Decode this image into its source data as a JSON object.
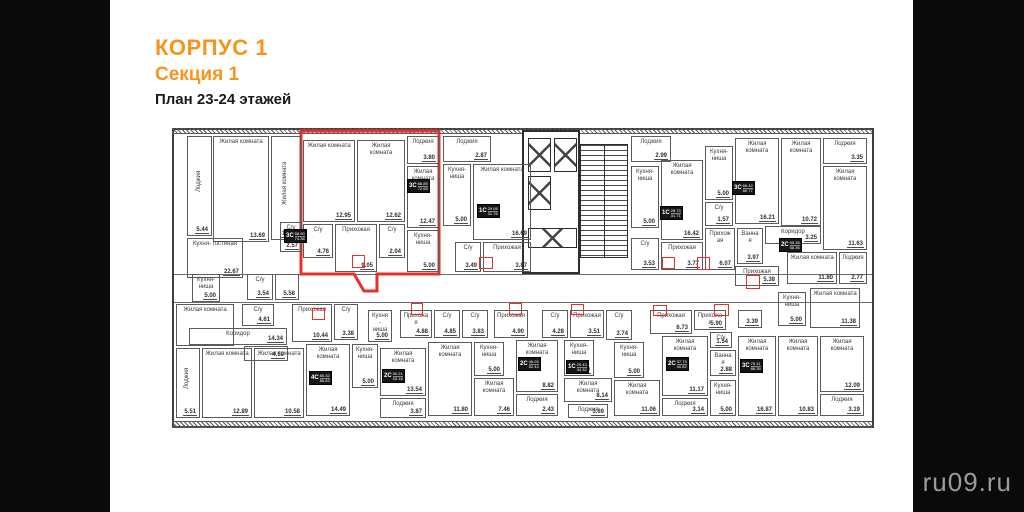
{
  "page": {
    "title1": "КОРПУС 1",
    "title2": "Секция 1",
    "title3": "План 23-24 этажей",
    "watermark": "ru09.ru",
    "accent_color": "#f7941d",
    "highlight_color": "#e5312b"
  },
  "plan": {
    "rooms": [
      {
        "label": "Лоджия",
        "area": "5.44",
        "x": 13,
        "y": 6,
        "w": 25,
        "h": 100,
        "vert": true
      },
      {
        "label": "Жилая комната",
        "area": "13.69",
        "x": 39,
        "y": 6,
        "w": 56,
        "h": 106
      },
      {
        "label": "Жилая комната",
        "area": "15.87",
        "x": 97,
        "y": 6,
        "w": 30,
        "h": 104,
        "vert": true
      },
      {
        "label": "Жилая комната",
        "area": "12.95",
        "x": 129,
        "y": 10,
        "w": 52,
        "h": 82
      },
      {
        "label": "Жилая комната",
        "area": "12.62",
        "x": 183,
        "y": 10,
        "w": 48,
        "h": 82
      },
      {
        "label": "Лоджия",
        "area": "3.80",
        "x": 233,
        "y": 6,
        "w": 32,
        "h": 28
      },
      {
        "label": "Жилая комната",
        "area": "12.47",
        "x": 233,
        "y": 36,
        "w": 32,
        "h": 62
      },
      {
        "label": "Кухня- ниша",
        "area": "5.00",
        "x": 233,
        "y": 100,
        "w": 32,
        "h": 42
      },
      {
        "label": "С/у",
        "area": "4.76",
        "x": 129,
        "y": 94,
        "w": 30,
        "h": 34
      },
      {
        "label": "Прихожая",
        "area": "9.05",
        "x": 161,
        "y": 94,
        "w": 42,
        "h": 48
      },
      {
        "label": "С/у",
        "area": "2.04",
        "x": 205,
        "y": 94,
        "w": 26,
        "h": 34
      },
      {
        "label": "С/у",
        "area": "2.57",
        "x": 106,
        "y": 92,
        "w": 22,
        "h": 30
      },
      {
        "label": "Кухня- гостиная",
        "area": "22.67",
        "x": 13,
        "y": 108,
        "w": 56,
        "h": 40
      },
      {
        "label": "Лоджия",
        "area": "2.87",
        "x": 269,
        "y": 6,
        "w": 48,
        "h": 26
      },
      {
        "label": "Кухня- ниша",
        "area": "5.00",
        "x": 269,
        "y": 34,
        "w": 28,
        "h": 62
      },
      {
        "label": "Жилая комната",
        "area": "16.69",
        "x": 299,
        "y": 34,
        "w": 58,
        "h": 76
      },
      {
        "label": "С/у",
        "area": "3.49",
        "x": 281,
        "y": 112,
        "w": 26,
        "h": 30
      },
      {
        "label": "Прихожая",
        "area": "3.87",
        "x": 309,
        "y": 112,
        "w": 48,
        "h": 30
      },
      {
        "label": "Лоджия",
        "area": "2.99",
        "x": 457,
        "y": 6,
        "w": 40,
        "h": 26
      },
      {
        "label": "Кухня- ниша",
        "area": "5.00",
        "x": 457,
        "y": 36,
        "w": 28,
        "h": 62
      },
      {
        "label": "С/у",
        "area": "3.53",
        "x": 457,
        "y": 108,
        "w": 28,
        "h": 32
      },
      {
        "label": "Жилая комната",
        "area": "16.42",
        "x": 487,
        "y": 30,
        "w": 42,
        "h": 80
      },
      {
        "label": "Прихожая",
        "area": "3.77",
        "x": 487,
        "y": 112,
        "w": 42,
        "h": 28
      },
      {
        "label": "Кухня- ниша",
        "area": "5.00",
        "x": 531,
        "y": 16,
        "w": 28,
        "h": 54
      },
      {
        "label": "С/у",
        "area": "1.57",
        "x": 531,
        "y": 72,
        "w": 28,
        "h": 24
      },
      {
        "label": "Прихожая",
        "area": "6.07",
        "x": 531,
        "y": 98,
        "w": 30,
        "h": 42
      },
      {
        "label": "Ванная",
        "area": "3.97",
        "x": 563,
        "y": 98,
        "w": 26,
        "h": 36
      },
      {
        "label": "Жилая комната",
        "area": "16.21",
        "x": 561,
        "y": 8,
        "w": 44,
        "h": 86
      },
      {
        "label": "Жилая комната",
        "area": "10.72",
        "x": 607,
        "y": 8,
        "w": 40,
        "h": 88
      },
      {
        "label": "Лоджия",
        "area": "3.35",
        "x": 649,
        "y": 8,
        "w": 44,
        "h": 26
      },
      {
        "label": "Жилая комната",
        "area": "11.63",
        "x": 649,
        "y": 36,
        "w": 44,
        "h": 84
      },
      {
        "label": "Коридор",
        "area": "3.25",
        "x": 591,
        "y": 96,
        "w": 56,
        "h": 18
      },
      {
        "label": "Жилая комната",
        "area": "11.80",
        "x": 613,
        "y": 122,
        "w": 50,
        "h": 32
      },
      {
        "label": "Лоджия",
        "area": "2.77",
        "x": 665,
        "y": 122,
        "w": 28,
        "h": 32
      },
      {
        "label": "Прихожая",
        "area": "5.38",
        "x": 561,
        "y": 136,
        "w": 44,
        "h": 20
      },
      {
        "label": "Кухня- ниша",
        "area": "5.00",
        "x": 18,
        "y": 144,
        "w": 28,
        "h": 28
      },
      {
        "label": "С/у",
        "area": "3.54",
        "x": 73,
        "y": 144,
        "w": 26,
        "h": 26
      },
      {
        "label": "",
        "area": "5.58",
        "x": 101,
        "y": 144,
        "w": 24,
        "h": 26
      },
      {
        "label": "Жилая комната",
        "area": "",
        "x": 2,
        "y": 174,
        "w": 58,
        "h": 42
      },
      {
        "label": "С/у",
        "area": "4.61",
        "x": 68,
        "y": 174,
        "w": 32,
        "h": 22
      },
      {
        "label": "Коридор",
        "area": "14.34",
        "x": 15,
        "y": 198,
        "w": 98,
        "h": 17
      },
      {
        "label": "",
        "area": "4.59",
        "x": 70,
        "y": 216,
        "w": 44,
        "h": 15
      },
      {
        "label": "Лоджия",
        "area": "5.51",
        "x": 2,
        "y": 218,
        "w": 24,
        "h": 70,
        "vert": true
      },
      {
        "label": "Жилая комната",
        "area": "12.89",
        "x": 28,
        "y": 218,
        "w": 50,
        "h": 70
      },
      {
        "label": "Жилая комната",
        "area": "10.58",
        "x": 80,
        "y": 218,
        "w": 50,
        "h": 70
      },
      {
        "label": "Прихожая",
        "area": "10.44",
        "x": 118,
        "y": 174,
        "w": 40,
        "h": 38
      },
      {
        "label": "С/у",
        "area": "3.38",
        "x": 160,
        "y": 174,
        "w": 24,
        "h": 36
      },
      {
        "label": "Жилая комната",
        "area": "14.49",
        "x": 132,
        "y": 214,
        "w": 44,
        "h": 72
      },
      {
        "label": "Кухня- ниша",
        "area": "5.00",
        "x": 178,
        "y": 214,
        "w": 26,
        "h": 44
      },
      {
        "label": "Кухня- ниша",
        "area": "5.00",
        "x": 194,
        "y": 180,
        "w": 24,
        "h": 32
      },
      {
        "label": "Жилая комната",
        "area": "13.54",
        "x": 206,
        "y": 218,
        "w": 46,
        "h": 48
      },
      {
        "label": "Лоджия",
        "area": "3.87",
        "x": 206,
        "y": 268,
        "w": 46,
        "h": 20
      },
      {
        "label": "Прихожая",
        "area": "4.88",
        "x": 226,
        "y": 180,
        "w": 32,
        "h": 28
      },
      {
        "label": "С/у",
        "area": "4.85",
        "x": 260,
        "y": 180,
        "w": 26,
        "h": 28
      },
      {
        "label": "Жилая комната",
        "area": "11.80",
        "x": 254,
        "y": 212,
        "w": 44,
        "h": 74
      },
      {
        "label": "С/у",
        "area": "3.83",
        "x": 288,
        "y": 180,
        "w": 26,
        "h": 28
      },
      {
        "label": "Кухня- ниша",
        "area": "5.00",
        "x": 300,
        "y": 212,
        "w": 30,
        "h": 34
      },
      {
        "label": "Жилая комната",
        "area": "7.46",
        "x": 300,
        "y": 248,
        "w": 40,
        "h": 38
      },
      {
        "label": "Прихожая",
        "area": "4.90",
        "x": 320,
        "y": 180,
        "w": 34,
        "h": 28
      },
      {
        "label": "Жилая комната",
        "area": "8.82",
        "x": 342,
        "y": 210,
        "w": 42,
        "h": 52
      },
      {
        "label": "Лоджия",
        "area": "2.43",
        "x": 342,
        "y": 264,
        "w": 42,
        "h": 22
      },
      {
        "label": "С/у",
        "area": "4.28",
        "x": 368,
        "y": 180,
        "w": 26,
        "h": 28
      },
      {
        "label": "Прихожая",
        "area": "3.51",
        "x": 396,
        "y": 180,
        "w": 34,
        "h": 28
      },
      {
        "label": "Кухня- ниша",
        "area": "5.00",
        "x": 390,
        "y": 210,
        "w": 30,
        "h": 36
      },
      {
        "label": "Жилая комната",
        "area": "8.14",
        "x": 390,
        "y": 248,
        "w": 48,
        "h": 24
      },
      {
        "label": "Лоджия",
        "area": "3.69",
        "x": 394,
        "y": 274,
        "w": 40,
        "h": 14
      },
      {
        "label": "С/у",
        "area": "3.74",
        "x": 432,
        "y": 180,
        "w": 26,
        "h": 30
      },
      {
        "label": "Кухня- ниша",
        "area": "5.00",
        "x": 440,
        "y": 212,
        "w": 30,
        "h": 36
      },
      {
        "label": "Жилая комната",
        "area": "11.06",
        "x": 440,
        "y": 250,
        "w": 46,
        "h": 36
      },
      {
        "label": "Прихожая",
        "area": "6.73",
        "x": 476,
        "y": 180,
        "w": 42,
        "h": 24
      },
      {
        "label": "Жилая комната",
        "area": "11.17",
        "x": 488,
        "y": 206,
        "w": 46,
        "h": 60
      },
      {
        "label": "Лоджия",
        "area": "3.14",
        "x": 488,
        "y": 268,
        "w": 46,
        "h": 18
      },
      {
        "label": "Прихожая",
        "area": "5.90",
        "x": 520,
        "y": 180,
        "w": 32,
        "h": 20
      },
      {
        "label": "С/у",
        "area": "1.54",
        "x": 536,
        "y": 202,
        "w": 22,
        "h": 16
      },
      {
        "label": "Ванная",
        "area": "2.88",
        "x": 536,
        "y": 220,
        "w": 26,
        "h": 26
      },
      {
        "label": "Кухня- ниша",
        "area": "5.00",
        "x": 536,
        "y": 250,
        "w": 26,
        "h": 36
      },
      {
        "label": "",
        "area": "3.39",
        "x": 564,
        "y": 180,
        "w": 24,
        "h": 18
      },
      {
        "label": "Кухня- ниша",
        "area": "5.00",
        "x": 604,
        "y": 162,
        "w": 28,
        "h": 34
      },
      {
        "label": "Жилая комната",
        "area": "11.38",
        "x": 636,
        "y": 158,
        "w": 50,
        "h": 40
      },
      {
        "label": "Жилая комната",
        "area": "16.87",
        "x": 564,
        "y": 206,
        "w": 38,
        "h": 80
      },
      {
        "label": "Жилая комната",
        "area": "10.83",
        "x": 604,
        "y": 206,
        "w": 40,
        "h": 80
      },
      {
        "label": "Жилая комната",
        "area": "12.09",
        "x": 646,
        "y": 206,
        "w": 44,
        "h": 56
      },
      {
        "label": "Лоджия",
        "area": "3.19",
        "x": 646,
        "y": 264,
        "w": 44,
        "h": 22
      }
    ],
    "tags": [
      {
        "code": "3С",
        "a1": "58.90",
        "a2": "74.38",
        "x": 110,
        "y": 99
      },
      {
        "code": "3С",
        "a1": "68.89",
        "a2": "72.65",
        "x": 233,
        "y": 49
      },
      {
        "code": "1С",
        "a1": "29.05",
        "a2": "31.76",
        "x": 303,
        "y": 74
      },
      {
        "code": "1С",
        "a1": "28.73",
        "a2": "31.71",
        "x": 486,
        "y": 76
      },
      {
        "code": "3С",
        "a1": "66.42",
        "a2": "80.77",
        "x": 558,
        "y": 51
      },
      {
        "code": "2С",
        "a1": "55.35",
        "a2": "58.36",
        "x": 605,
        "y": 108
      },
      {
        "code": "4С",
        "a1": "80.32",
        "a2": "85.83",
        "x": 135,
        "y": 241
      },
      {
        "code": "2С",
        "a1": "50.21",
        "a2": "53.16",
        "x": 208,
        "y": 239
      },
      {
        "code": "2С",
        "a1": "46.03",
        "a2": "52.44",
        "x": 344,
        "y": 227
      },
      {
        "code": "1С",
        "a1": "29.43",
        "a2": "34.32",
        "x": 392,
        "y": 230
      },
      {
        "code": "2С",
        "a1": "37.73",
        "a2": "40.82",
        "x": 492,
        "y": 227
      },
      {
        "code": "3С",
        "a1": "75.11",
        "a2": "86.39",
        "x": 566,
        "y": 229
      }
    ],
    "red_boxes": [
      {
        "x": 178,
        "y": 125,
        "w": 13,
        "h": 13
      },
      {
        "x": 305,
        "y": 127,
        "w": 14,
        "h": 12
      },
      {
        "x": 488,
        "y": 127,
        "w": 13,
        "h": 12
      },
      {
        "x": 523,
        "y": 127,
        "w": 13,
        "h": 13
      },
      {
        "x": 572,
        "y": 145,
        "w": 14,
        "h": 14
      },
      {
        "x": 138,
        "y": 178,
        "w": 13,
        "h": 12
      },
      {
        "x": 237,
        "y": 173,
        "w": 12,
        "h": 12
      },
      {
        "x": 335,
        "y": 173,
        "w": 13,
        "h": 12
      },
      {
        "x": 397,
        "y": 174,
        "w": 13,
        "h": 11
      },
      {
        "x": 479,
        "y": 175,
        "w": 14,
        "h": 11
      },
      {
        "x": 540,
        "y": 174,
        "w": 15,
        "h": 12
      }
    ],
    "red_outline_points": "127,1 265,1 265,144 203,144 203,161 190,161 180,144 127,144"
  }
}
